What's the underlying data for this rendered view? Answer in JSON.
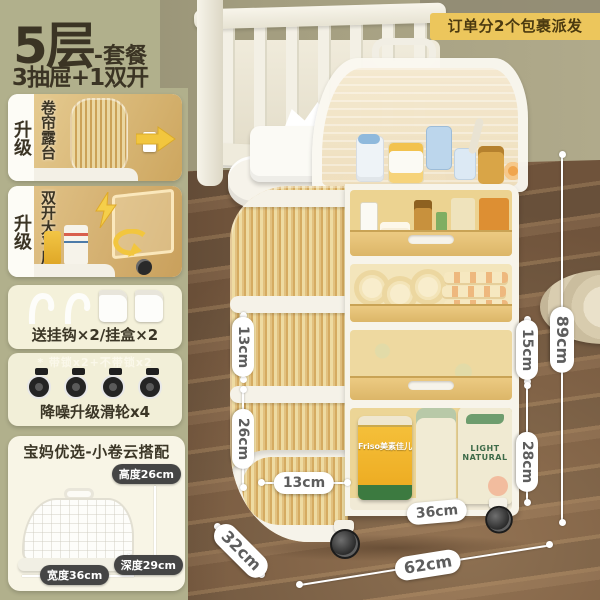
{
  "sidebar": {
    "title_main": "5层",
    "title_suffix": "-套餐",
    "subtitle": "3抽屉+1双开",
    "upgrade_label": "升级",
    "panel_rolling": "卷帘露台",
    "panel_double": "双开大平层",
    "gift_text": "送挂钩×2/挂盒×2",
    "lock_note": "* 带锁x2+不带锁x2",
    "wheels_text": "降噪升级滑轮x4",
    "combo_title": "宝妈优选-小卷云搭配",
    "box_height": "高度26cm",
    "box_width": "宽度36cm",
    "box_depth": "深度29cm"
  },
  "banner": {
    "text": "订单分2个包裹派发"
  },
  "measurements": {
    "tier_left": "13cm",
    "bottom_left": "26cm",
    "inner_width": "13cm",
    "shelf_width": "36cm",
    "tier_right": "15cm",
    "bottom_right": "28cm",
    "total_height": "89cm",
    "total_width": "62cm",
    "depth": "32cm"
  },
  "products": {
    "formula_text": "Friso美素佳儿",
    "bag_line1": "LIGHT",
    "bag_line2": "NATURAL"
  },
  "colors": {
    "sidebar_olive": "#b1b08c",
    "banner_yellow": "#ecc65c",
    "drawer_amber": "#e8c87e",
    "dark_text": "#3b3424",
    "panel_cream": "#f4f1da",
    "dim_pill_dark": "#454545"
  }
}
